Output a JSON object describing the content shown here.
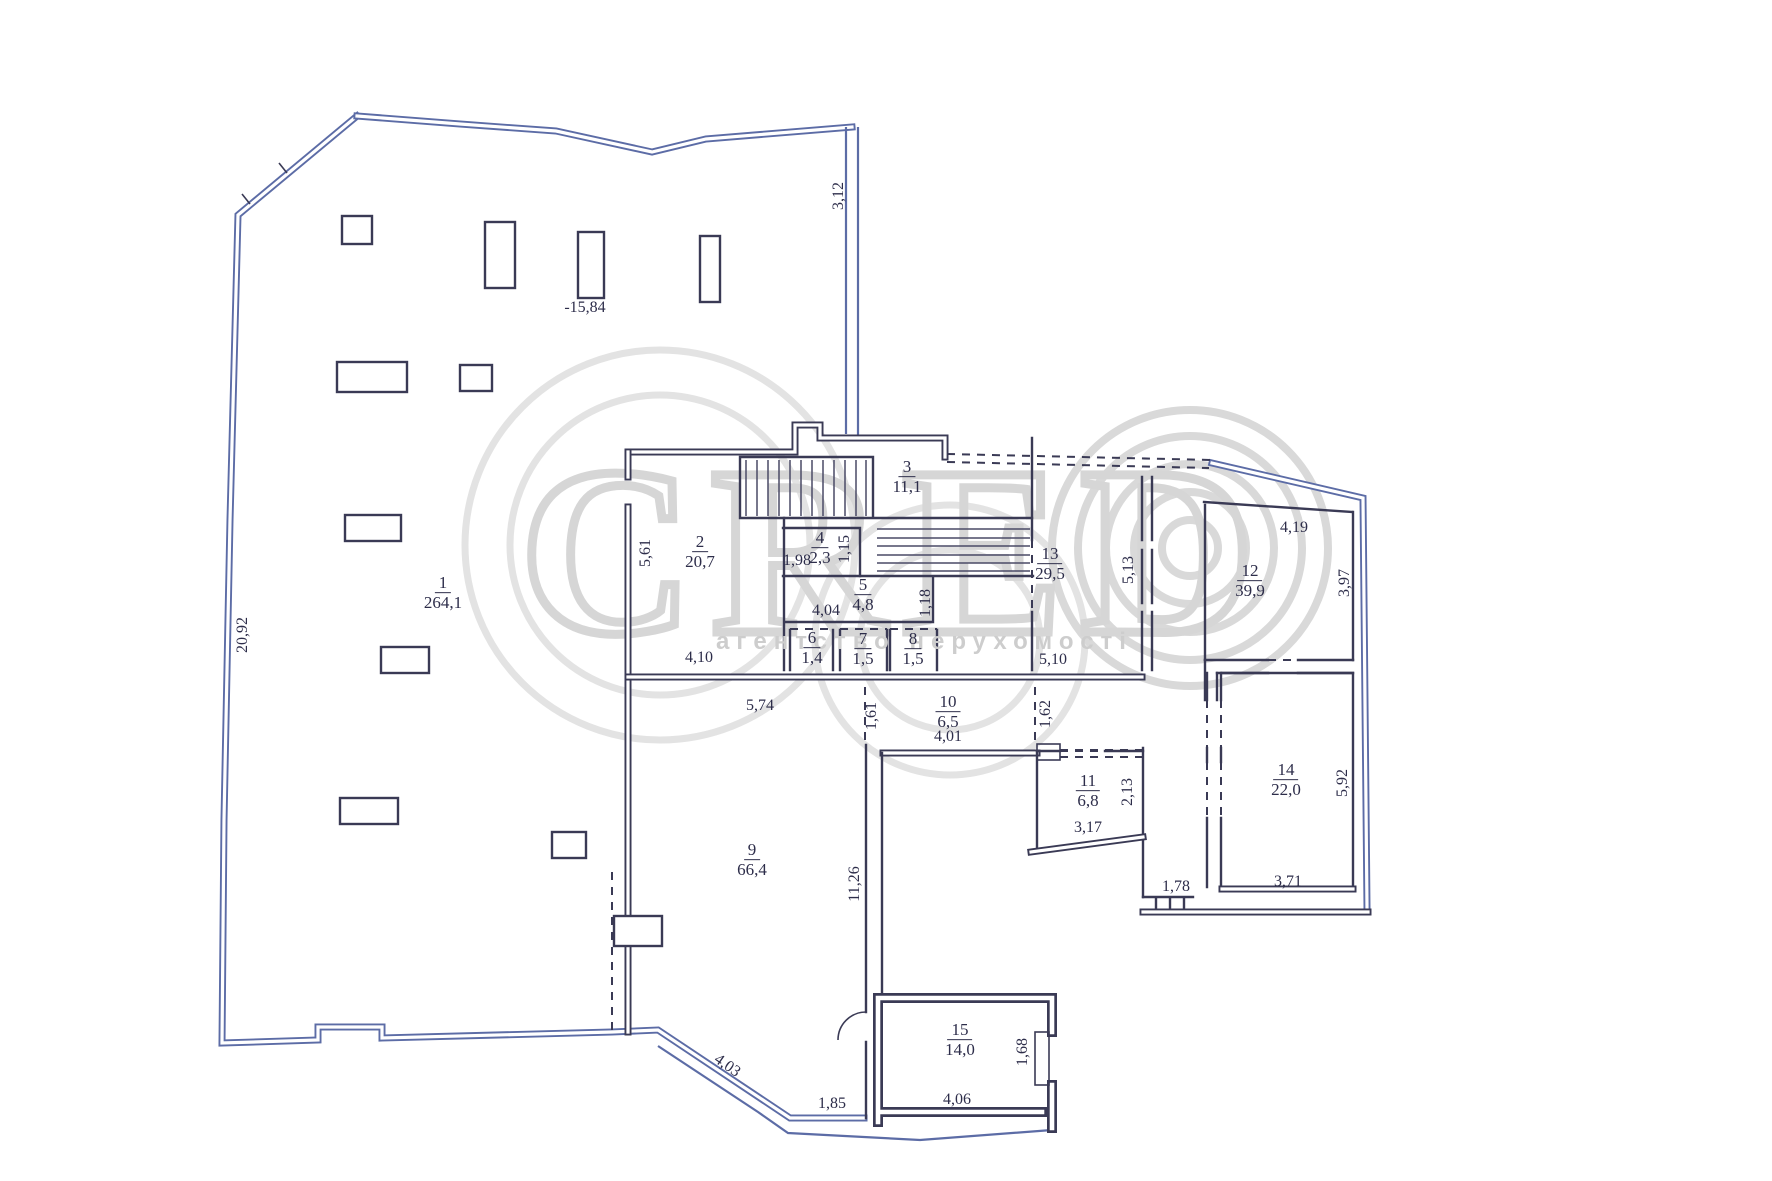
{
  "watermark": {
    "brand": "CRED",
    "tagline": "агентство нерухомості"
  },
  "plan": {
    "rooms": [
      {
        "number": "1",
        "area": "264,1",
        "x": 443,
        "y": 593
      },
      {
        "number": "2",
        "area": "20,7",
        "x": 700,
        "y": 552
      },
      {
        "number": "3",
        "area": "11,1",
        "x": 907,
        "y": 477
      },
      {
        "number": "4",
        "area": "2,3",
        "x": 820,
        "y": 548
      },
      {
        "number": "5",
        "area": "4,8",
        "x": 863,
        "y": 595
      },
      {
        "number": "6",
        "area": "1,4",
        "x": 812,
        "y": 648
      },
      {
        "number": "7",
        "area": "1,5",
        "x": 863,
        "y": 649
      },
      {
        "number": "8",
        "area": "1,5",
        "x": 913,
        "y": 649
      },
      {
        "number": "9",
        "area": "66,4",
        "x": 752,
        "y": 860
      },
      {
        "number": "10",
        "area": "6,5",
        "x": 948,
        "y": 712
      },
      {
        "number": "11",
        "area": "6,8",
        "x": 1088,
        "y": 791
      },
      {
        "number": "12",
        "area": "39,9",
        "x": 1250,
        "y": 581
      },
      {
        "number": "13",
        "area": "29,5",
        "x": 1050,
        "y": 564
      },
      {
        "number": "14",
        "area": "22,0",
        "x": 1286,
        "y": 780
      },
      {
        "number": "15",
        "area": "14,0",
        "x": 960,
        "y": 1040
      }
    ],
    "dimensions": [
      {
        "text": "20,92",
        "x": 243,
        "y": 635,
        "rot": -90
      },
      {
        "text": "3,12",
        "x": 839,
        "y": 196,
        "rot": -90
      },
      {
        "text": "-15,84",
        "x": 585,
        "y": 308,
        "rot": 0
      },
      {
        "text": "5,61",
        "x": 646,
        "y": 553,
        "rot": -90
      },
      {
        "text": "4,10",
        "x": 699,
        "y": 658,
        "rot": 0
      },
      {
        "text": "5,74",
        "x": 760,
        "y": 706,
        "rot": 0
      },
      {
        "text": "1,98",
        "x": 797,
        "y": 561,
        "rot": 0
      },
      {
        "text": "1,15",
        "x": 845,
        "y": 549,
        "rot": -90
      },
      {
        "text": "4,04",
        "x": 826,
        "y": 611,
        "rot": 0
      },
      {
        "text": "1,18",
        "x": 926,
        "y": 603,
        "rot": -90
      },
      {
        "text": "5,13",
        "x": 1129,
        "y": 570,
        "rot": -90
      },
      {
        "text": "4,19",
        "x": 1294,
        "y": 528,
        "rot": 0
      },
      {
        "text": "3,97",
        "x": 1345,
        "y": 583,
        "rot": -90
      },
      {
        "text": "5,10",
        "x": 1053,
        "y": 660,
        "rot": 0
      },
      {
        "text": "1,61",
        "x": 872,
        "y": 716,
        "rot": -90
      },
      {
        "text": "4,01",
        "x": 948,
        "y": 737,
        "rot": 0
      },
      {
        "text": "1,62",
        "x": 1046,
        "y": 714,
        "rot": -90
      },
      {
        "text": "2,13",
        "x": 1128,
        "y": 792,
        "rot": -90
      },
      {
        "text": "3,17",
        "x": 1088,
        "y": 828,
        "rot": 0
      },
      {
        "text": "5,92",
        "x": 1343,
        "y": 783,
        "rot": -90
      },
      {
        "text": "1,78",
        "x": 1176,
        "y": 887,
        "rot": 0
      },
      {
        "text": "3,71",
        "x": 1288,
        "y": 882,
        "rot": 0
      },
      {
        "text": "11,26",
        "x": 855,
        "y": 884,
        "rot": -90
      },
      {
        "text": "4,03",
        "x": 727,
        "y": 1066,
        "rot": 35
      },
      {
        "text": "1,85",
        "x": 832,
        "y": 1104,
        "rot": 0
      },
      {
        "text": "1,68",
        "x": 1023,
        "y": 1052,
        "rot": -90
      },
      {
        "text": "4,06",
        "x": 957,
        "y": 1100,
        "rot": 0
      }
    ]
  }
}
